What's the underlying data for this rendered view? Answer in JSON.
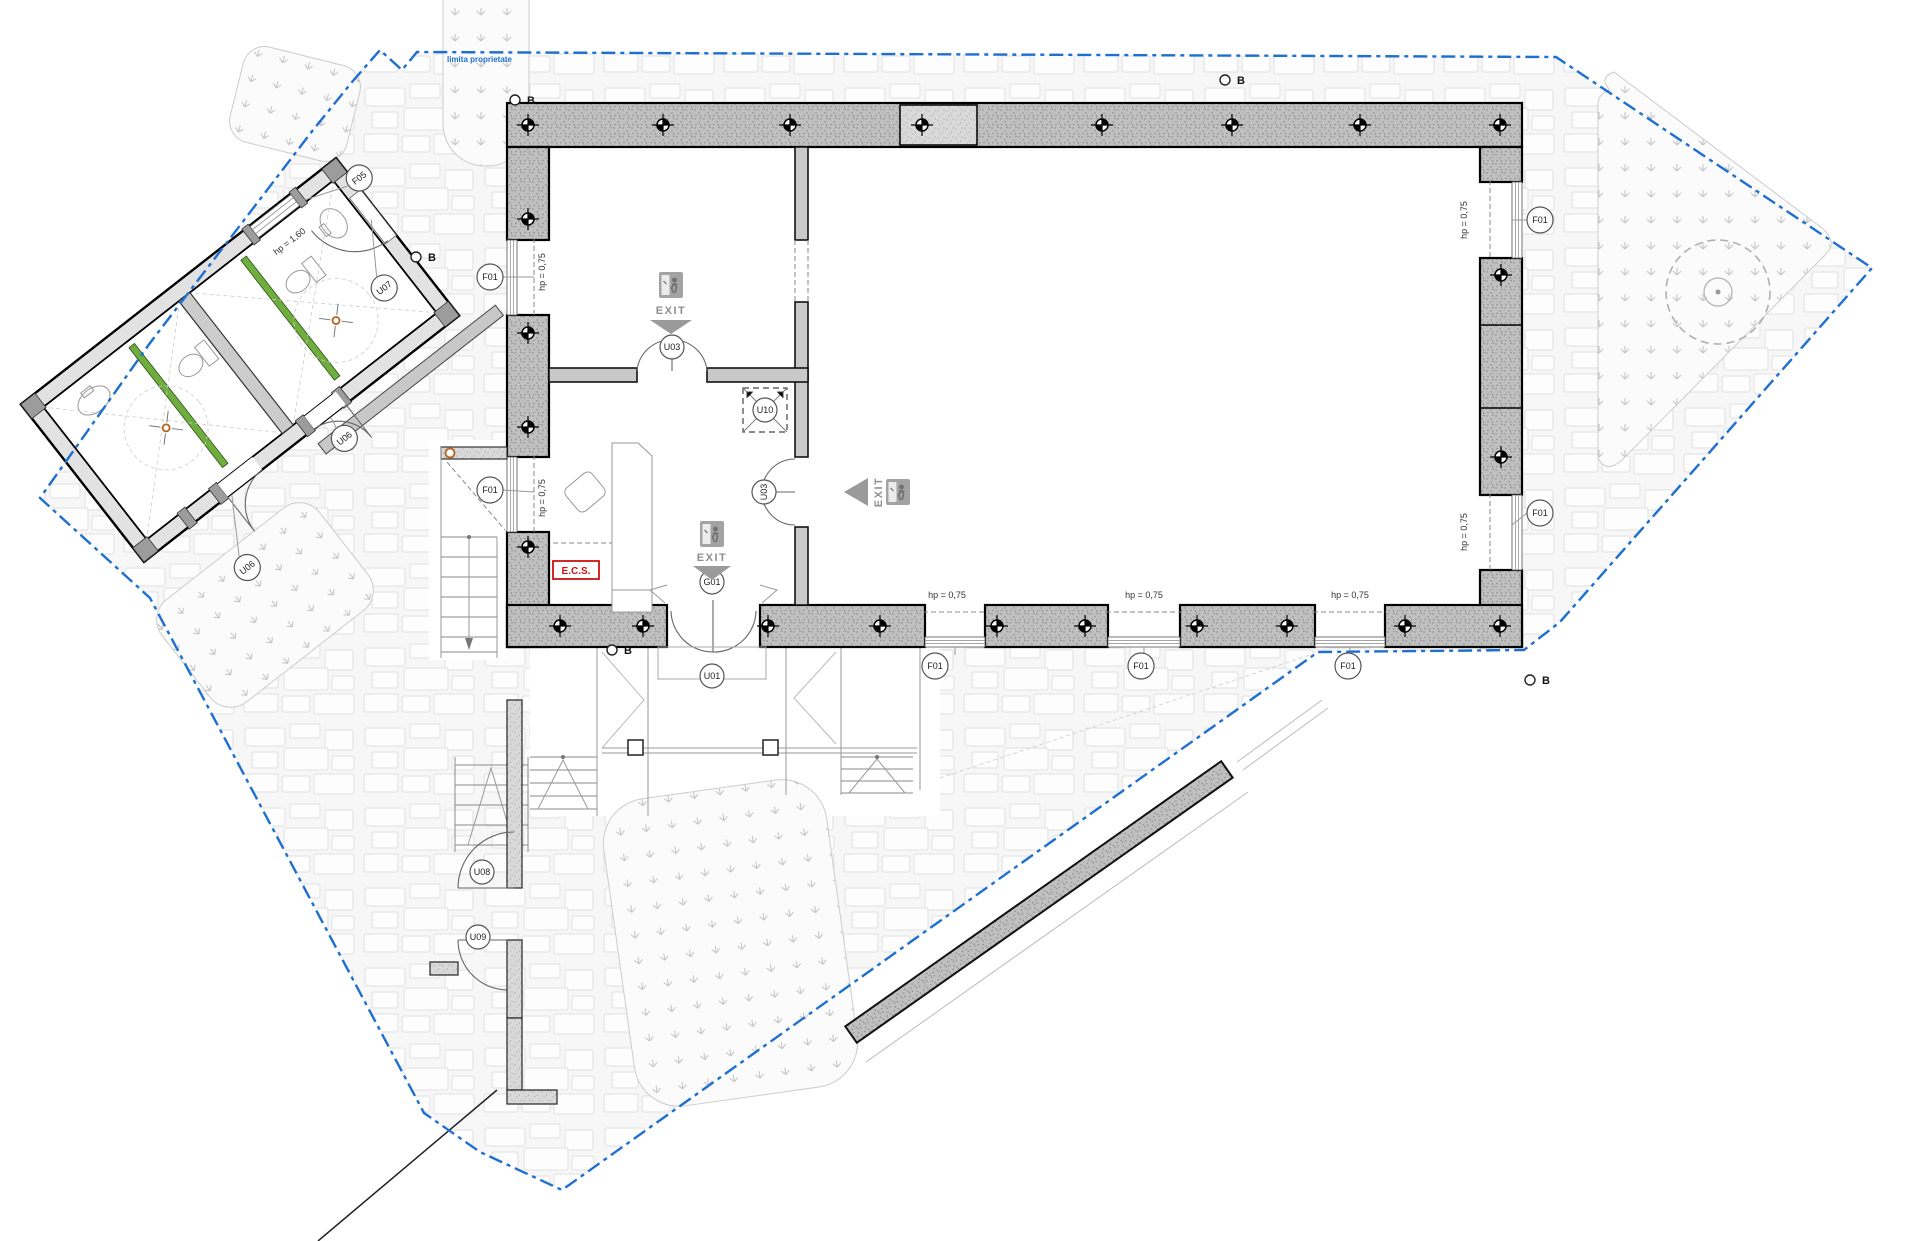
{
  "boundary": {
    "label": "limita proprietate"
  },
  "markers": {
    "section": "B"
  },
  "tags": {
    "f01": "F01",
    "f05": "F05",
    "u01": "U01",
    "u03": "U03",
    "u06": "U06",
    "u07": "U07",
    "u08": "U08",
    "u09": "U09",
    "u10": "U10",
    "g01": "G01"
  },
  "texts": {
    "exit": "EXIT",
    "ecs": "E.C.S.",
    "hp075": "hp = 0,75",
    "hp160": "hp = 1,60"
  },
  "colors": {
    "boundary": "#1d6fd1",
    "wall": "#c0c0c0",
    "wall_light": "#d9d9d9",
    "partition_green": "#6fae3e",
    "ecs_red": "#cc1111",
    "exit_gray": "#8f8f8f",
    "marker_orange": "#b5651d"
  }
}
